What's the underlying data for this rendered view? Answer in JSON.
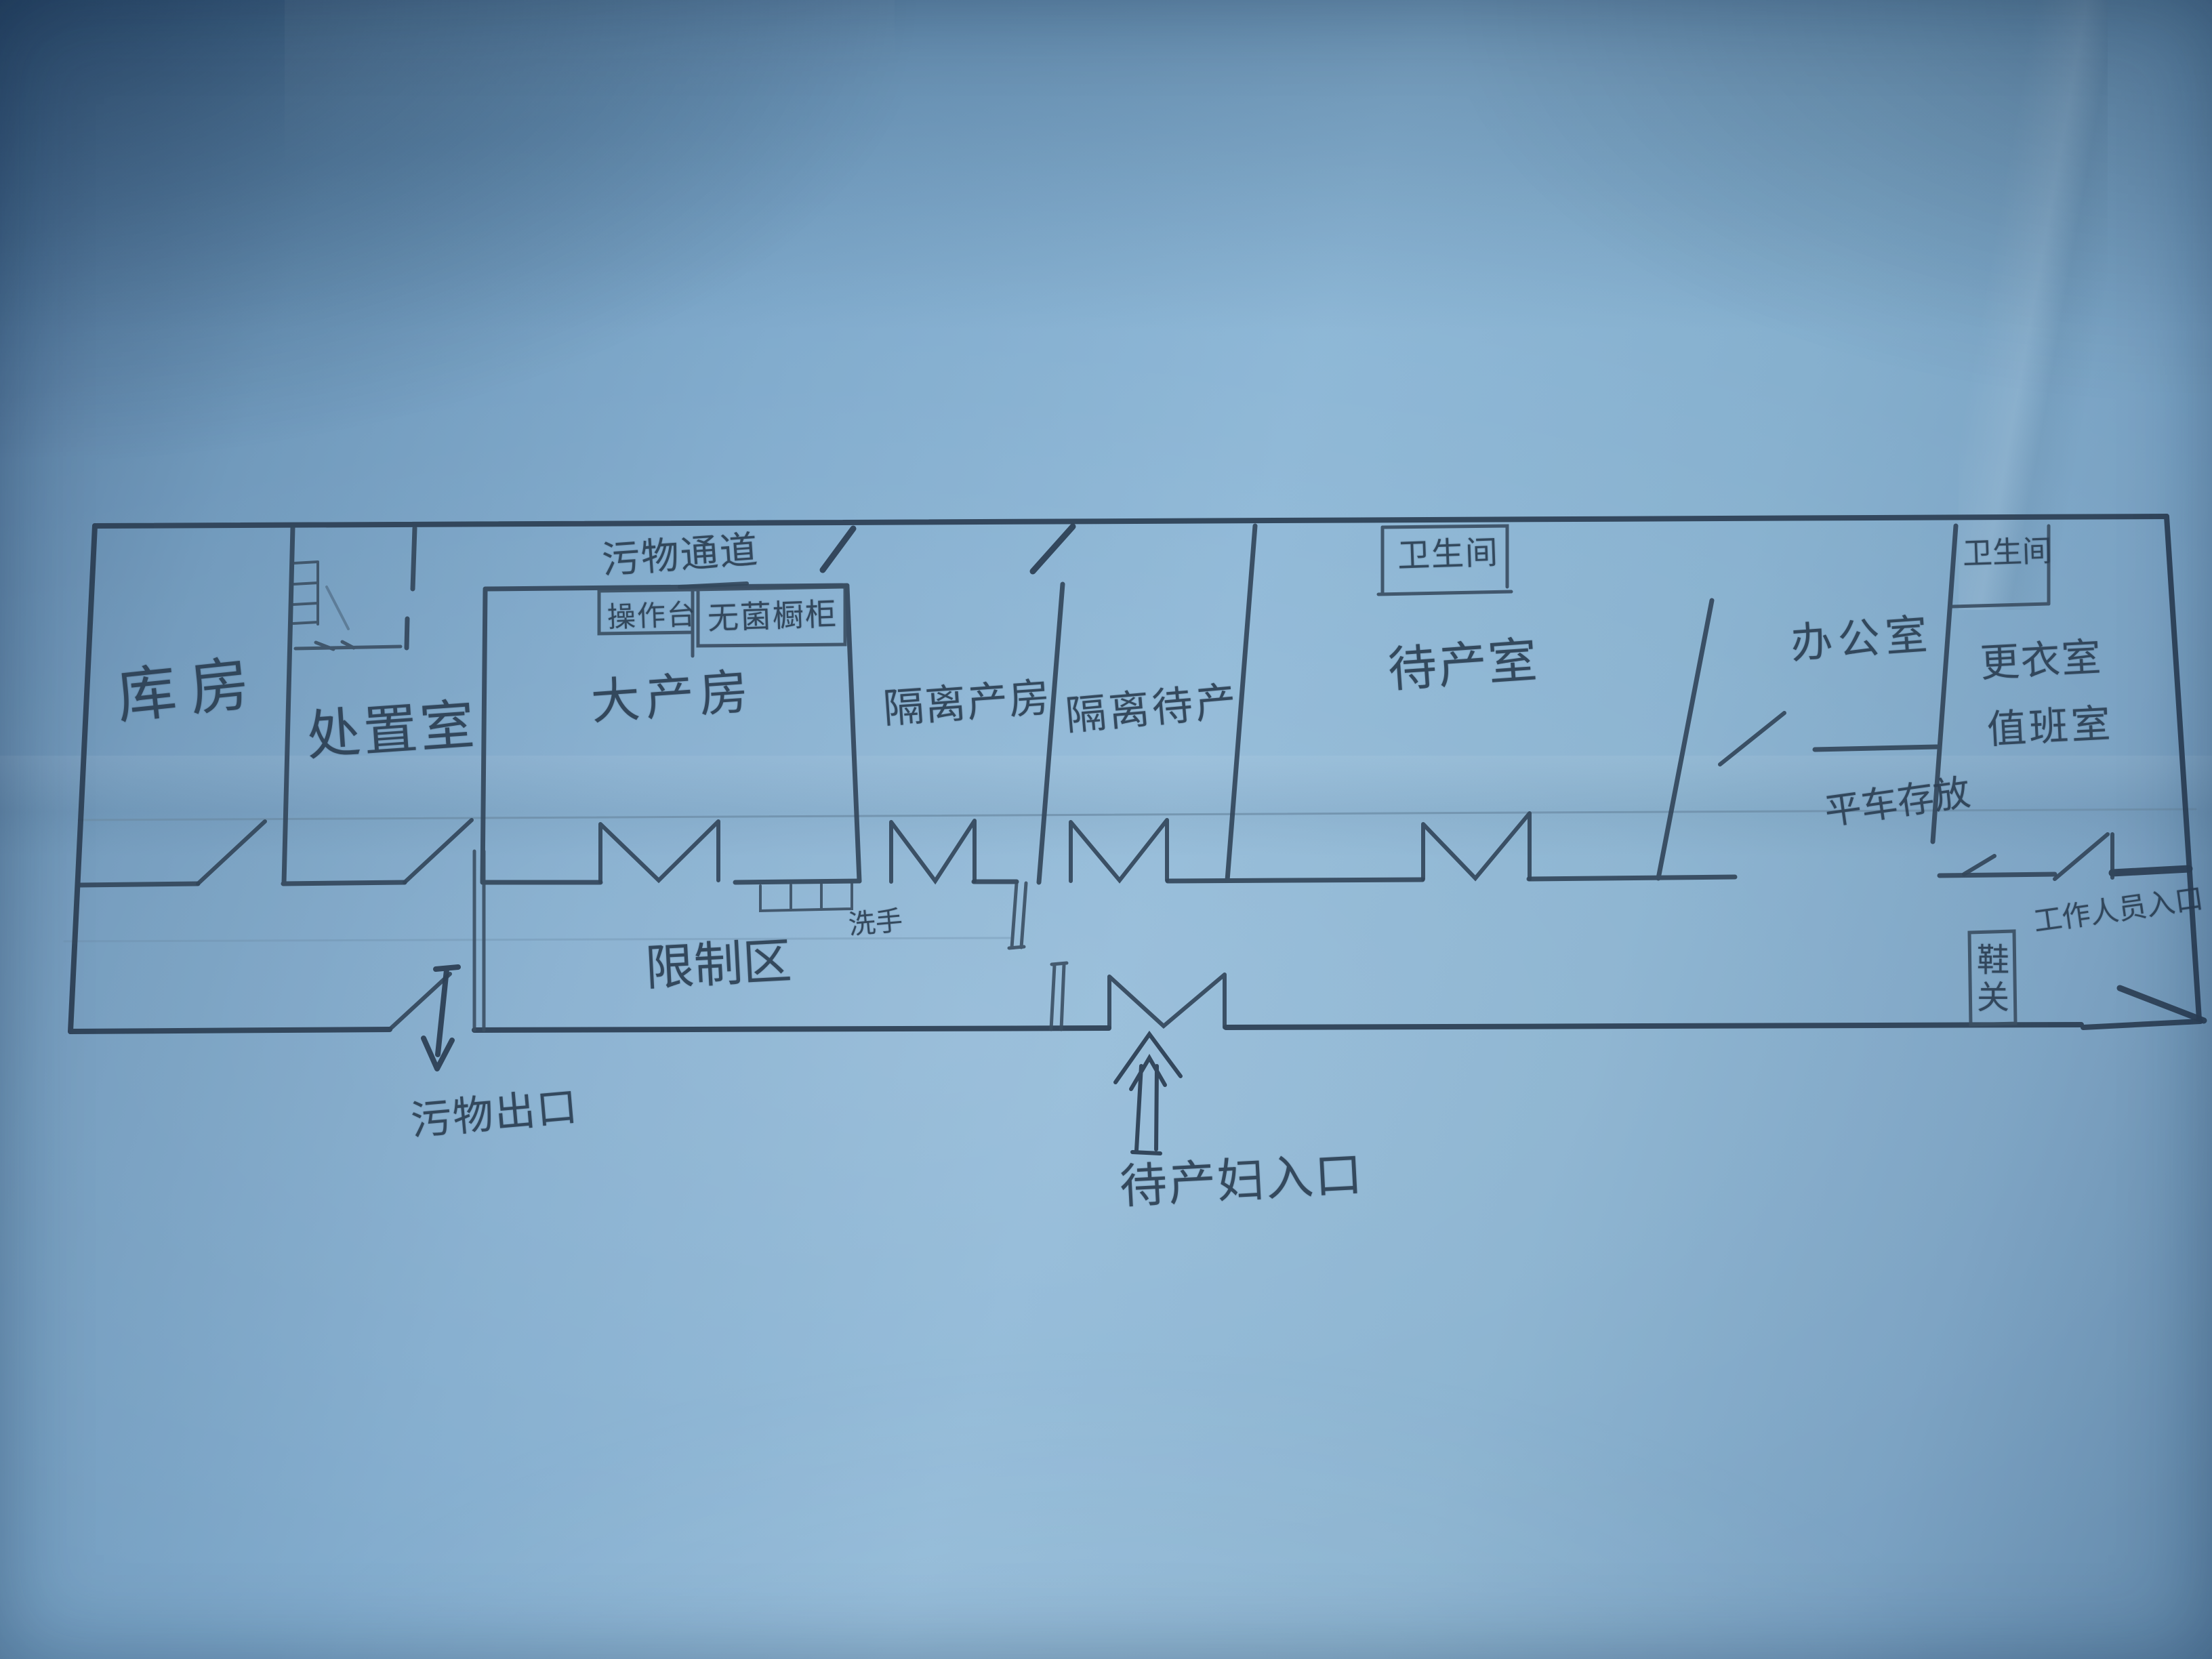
{
  "document": {
    "kind": "hand-drawn floor plan photograph",
    "language": "zh-CN",
    "paper_color": "#84afd0",
    "pencil_color": "#2e4156",
    "guideline_color": "#6c8ca6"
  },
  "labels": {
    "storage_room": "库房",
    "disposal_room": "处置室",
    "waste_corridor": "污物通道",
    "operating_counter": "操作台",
    "sterile_cabinet": "无菌橱柜",
    "main_delivery_room": "大产房",
    "isolation_delivery_room": "隔离产房",
    "isolation_waiting_room": "隔离待产",
    "toilet_left": "卫生间",
    "waiting_delivery_room": "待产室",
    "office": "办公室",
    "toilet_right": "卫生间",
    "changing_room": "更衣室",
    "duty_room": "值班室",
    "cart_storage": "平车存放",
    "restricted_area": "限制区",
    "hand_wash": "洗手",
    "staff_entrance": "工作人员入口",
    "shoe_cabinet": "鞋关",
    "waste_exit": "污物出口",
    "mothers_entrance": "待产妇入口"
  }
}
